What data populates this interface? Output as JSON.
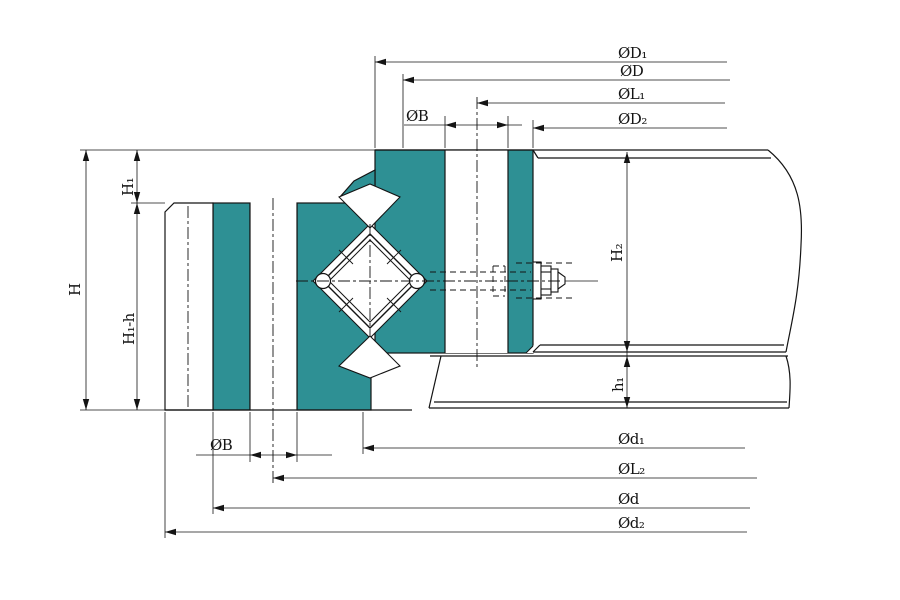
{
  "colors": {
    "background": "#ffffff",
    "line": "#141414",
    "ring_fill": "#2e9094"
  },
  "labels": {
    "top": [
      "ØD₁",
      "ØD",
      "ØL₁",
      "ØD₂"
    ],
    "bottom": [
      "Ød₁",
      "ØL₂",
      "Ød",
      "Ød₂"
    ],
    "left": [
      "H₁",
      "H",
      "H₁-h"
    ],
    "right": [
      "H₂",
      "h₁"
    ],
    "bore_top": "ØB",
    "bore_bottom": "ØB"
  }
}
